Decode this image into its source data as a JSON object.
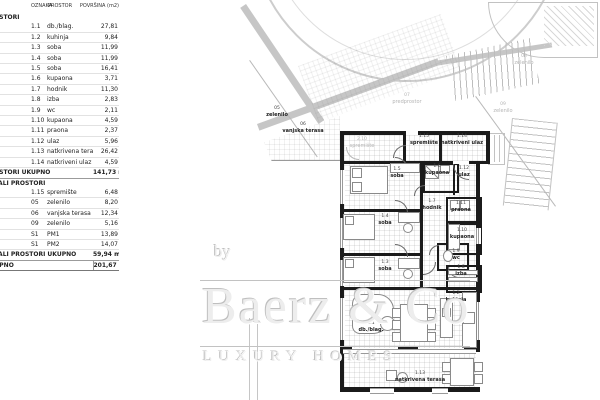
{
  "table": {
    "headers": {
      "oznaka": "OZNAKA",
      "prostor": "PROSTOR",
      "povrsina": "POVRŠINA (m2)"
    },
    "sections": [
      {
        "label": "PROSTORI",
        "rows": [
          {
            "oznaka": "1.1",
            "prostor": "db./blag.",
            "povrsina": "27,81"
          },
          {
            "oznaka": "1.2",
            "prostor": "kuhinja",
            "povrsina": "9,84"
          },
          {
            "oznaka": "1.3",
            "prostor": "soba",
            "povrsina": "11,99"
          },
          {
            "oznaka": "1.4",
            "prostor": "soba",
            "povrsina": "11,99"
          },
          {
            "oznaka": "1.5",
            "prostor": "soba",
            "povrsina": "16,41"
          },
          {
            "oznaka": "1.6",
            "prostor": "kupaona",
            "povrsina": "3,71"
          },
          {
            "oznaka": "1.7",
            "prostor": "hodnik",
            "povrsina": "11,30"
          },
          {
            "oznaka": "1.8",
            "prostor": "izba",
            "povrsina": "2,83"
          },
          {
            "oznaka": "1.9",
            "prostor": "wc",
            "povrsina": "2,11"
          },
          {
            "oznaka": "1.10",
            "prostor": "kupaona",
            "povrsina": "4,59"
          },
          {
            "oznaka": "1.11",
            "prostor": "praona",
            "povrsina": "2,37"
          },
          {
            "oznaka": "1.12",
            "prostor": "ulaz",
            "povrsina": "5,96"
          },
          {
            "oznaka": "1.13",
            "prostor": "natkrivena terasa",
            "povrsina": "26,42"
          },
          {
            "oznaka": "1.14",
            "prostor": "natkriveni ulaz",
            "povrsina": "4,59"
          }
        ],
        "total_label": "PROSTORI UKUPNO",
        "total_value": "141,73 m²"
      },
      {
        "label": "OSTALI PROSTORI",
        "rows": [
          {
            "oznaka": "1.15",
            "prostor": "spremište",
            "povrsina": "6,48"
          },
          {
            "oznaka": "05",
            "prostor": "zelenilo",
            "povrsina": "8,20"
          },
          {
            "oznaka": "06",
            "prostor": "vanjska terasa",
            "povrsina": "12,34"
          },
          {
            "oznaka": "09",
            "prostor": "zelenilo",
            "povrsina": "5,16"
          },
          {
            "oznaka": "S1",
            "prostor": "PM1",
            "povrsina": "13,89"
          },
          {
            "oznaka": "S1",
            "prostor": "PM2",
            "povrsina": "14,07"
          }
        ],
        "total_label": "OSTALI PROSTORI UKUPNO",
        "total_value": "59,94 m²"
      }
    ],
    "grand_total": {
      "label": "UKUPNO",
      "value": "201,67 m²"
    }
  },
  "plan": {
    "rooms": [
      {
        "id": "r115",
        "num": "1.15",
        "name": "spremište"
      },
      {
        "id": "r114",
        "num": "1.14",
        "name": "natkriveni ulaz"
      },
      {
        "id": "r15",
        "num": "1.5",
        "name": "soba"
      },
      {
        "id": "r16",
        "num": "1.6",
        "name": "kupaona"
      },
      {
        "id": "r112",
        "num": "1.12",
        "name": "ulaz"
      },
      {
        "id": "r17",
        "num": "1.7",
        "name": "hodnik"
      },
      {
        "id": "r111",
        "num": "1.11",
        "name": "praona"
      },
      {
        "id": "r14",
        "num": "1.4",
        "name": "soba"
      },
      {
        "id": "r110",
        "num": "1.10",
        "name": "kupaona"
      },
      {
        "id": "r13",
        "num": "1.3",
        "name": "soba"
      },
      {
        "id": "r19",
        "num": "1.9",
        "name": "wc"
      },
      {
        "id": "r18",
        "num": "1.8",
        "name": "izba"
      },
      {
        "id": "r12",
        "num": "1.2",
        "name": "kuhinja"
      },
      {
        "id": "r11",
        "num": "1.1",
        "name": "db./blag."
      },
      {
        "id": "r113",
        "num": "1.13",
        "name": "natkrivena terasa"
      },
      {
        "id": "o05",
        "num": "05",
        "name": "zelenilo"
      },
      {
        "id": "o06",
        "num": "06",
        "name": "vanjska terasa"
      }
    ],
    "outdoor_gray": [
      {
        "id": "g07",
        "num": "07",
        "name": "predprostor"
      },
      {
        "id": "g210",
        "num": "2.10",
        "name": "spremište"
      },
      {
        "id": "g08",
        "num": "08",
        "name": "zelenilo"
      },
      {
        "id": "g09",
        "num": "09",
        "name": "zelenilo"
      }
    ]
  },
  "watermark": {
    "by": "by",
    "name": "Baerz & Co",
    "tagline": "LUXURY HOMES"
  },
  "colors": {
    "wall": "#1b1b1b",
    "path_gray": "#c6c6c6",
    "label_gray": "#b5b5b5",
    "watermark_gray": "#c2c2c2"
  }
}
